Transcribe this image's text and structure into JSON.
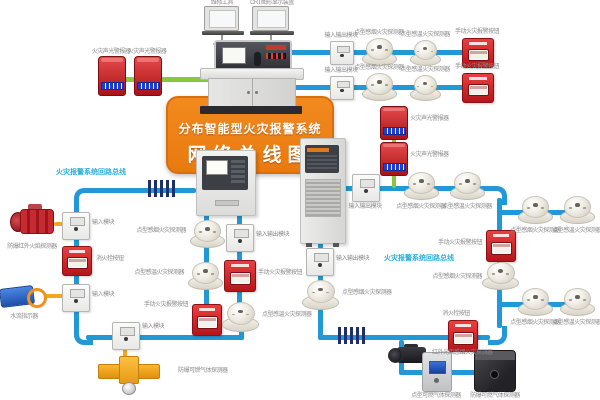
{
  "banner": {
    "line1": "分布智能型火灾报警系统",
    "line2": "网络总线图"
  },
  "workstations": {
    "left": "维修工具",
    "right": "CRT图形显示装置"
  },
  "annotations": {
    "left_bus": "火灾报警系统回路总线",
    "right_bus": "火灾报警系统回路总线"
  },
  "colors": {
    "bus_blue": "#2398d6",
    "broadcast_green": "#8cc640",
    "connector_yellow": "#f6a61c",
    "banner_orange": "#ee8418",
    "annotation_cyan": "#2aaede",
    "device_red": "#c8232a"
  },
  "top_left": {
    "alarm1": "火灾声光警报器",
    "alarm2": "火灾声光警报器"
  },
  "rows": [
    {
      "module": "输入输出模块",
      "detector1": "点型感烟火灾探测器",
      "detector2": "点型感温火灾探测器",
      "call": "手动火灾报警按钮"
    },
    {
      "module": "输入输出模块",
      "detector1": "点型感烟火灾探测器",
      "detector2": "点型感温火灾探测器",
      "call": "手动火灾报警按钮"
    }
  ],
  "left_loop": {
    "flame": "防爆红外火焰探测器",
    "flame_module": "输入模块",
    "hydrant": "消火栓按钮",
    "flow_module": "输入模块",
    "flow": "水流指示器",
    "gas_module": "输入模块",
    "gas": "防爆可燃气体探测器",
    "call": "手动火灾报警按钮",
    "chain_detector1": "点型感烟火灾探测器",
    "chain_detector2": "点型感温火灾探测器",
    "right_module": "输入输出模块",
    "right_call": "手动火灾报警按钮",
    "right_detector": "点型感温火灾探测器"
  },
  "right_loop": {
    "module": "输入输出模块",
    "sounder1": "火灾声光警报器",
    "sounder2": "火灾声光警报器",
    "detector1": "点型感烟火灾探测器",
    "detector2": "点型感温火灾探测器",
    "branch1_detector1": "点型感烟火灾探测器",
    "branch1_detector2": "点型感温火灾探测器",
    "call": "手动火灾报警按钮",
    "detector3": "点型感烟火灾探测器",
    "branch2_detector1": "点型感烟火灾探测器",
    "branch2_detector2": "点型感温火灾探测器",
    "hydrant": "消火栓按钮",
    "beam_detector": "红外光束感烟火灾探测器",
    "gas_detector": "点型可燃气体探测器",
    "ex_gas_detector": "防爆可燃气体探测器",
    "panel_module": "输入输出模块",
    "panel_detector": "点型感烟火灾探测器"
  }
}
